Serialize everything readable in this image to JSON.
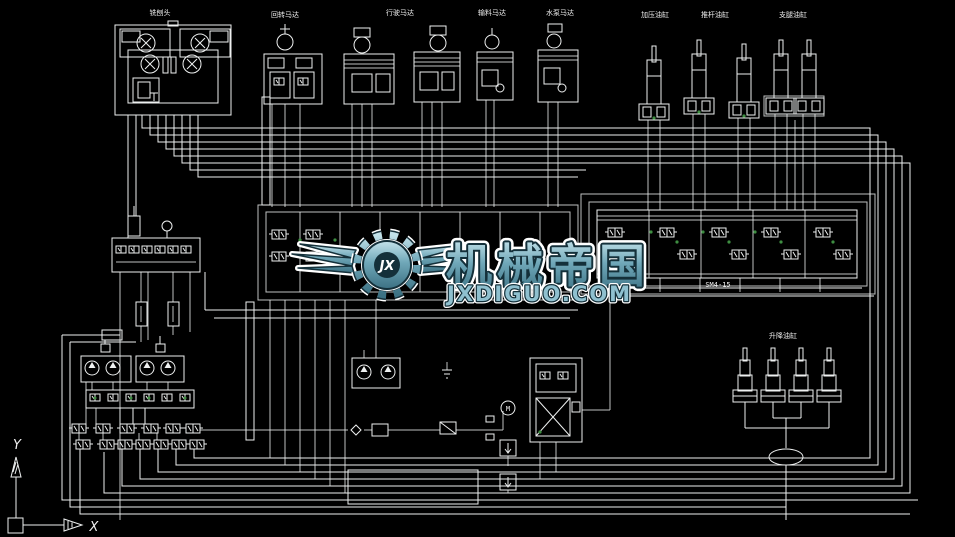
{
  "canvas": {
    "bg": "#000000",
    "line_color": "#EEF0F0",
    "accent_green": "#3E8E41"
  },
  "labels": {
    "milling_head": "铣刨头",
    "rotary_motor": "回转马达",
    "travel_motor": "行驶马达",
    "conveyor_motor": "输料马达",
    "water_pump_motor": "水泵马达",
    "press_cylinder": "加压油缸",
    "push_rod_cylinder": "推杆油缸",
    "outrigger_cylinder": "支腿油缸",
    "lift_cylinder": "升降油缸",
    "valve_model": "SM4-15",
    "motor_mark": "M"
  },
  "axes": {
    "x": "X",
    "y": "Y"
  },
  "watermark": {
    "brand": "机械帝国",
    "site": "JXDIGUO.COM",
    "monogram": "JX",
    "teal": "#6FA7B8",
    "dark_outline": "#14303A"
  }
}
